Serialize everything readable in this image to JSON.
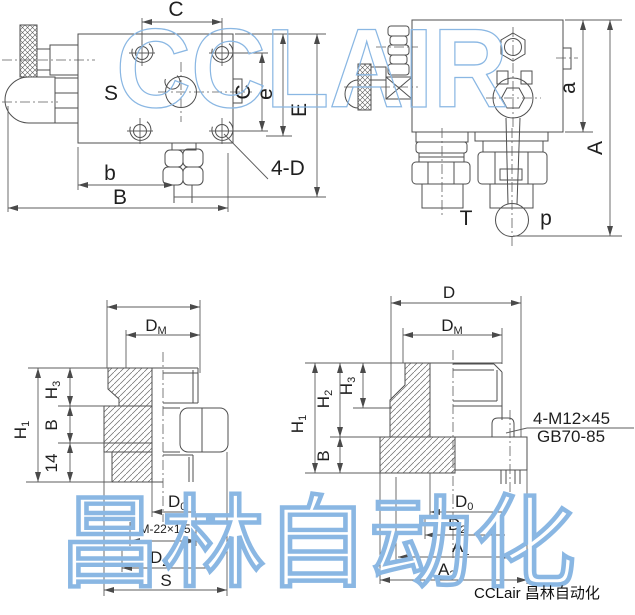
{
  "watermarks": {
    "brand_top": "CCLAIR",
    "brand_bottom": "昌林自动化"
  },
  "caption": "CCLair 昌林自动化",
  "colors": {
    "drawing_line": "#4f4f4f",
    "dimension_line": "#5c5c5c",
    "watermark_blue": "#8ab7e3",
    "label_text": "#1f1f1f"
  },
  "views": {
    "top_view": {
      "labels": {
        "c_top": "C",
        "s_body": "S",
        "c_right": "C",
        "e_small": "e",
        "e_big": "E",
        "holes": "4-D",
        "b_small": "b",
        "b_big": "B"
      }
    },
    "side_view": {
      "labels": {
        "a_small": "a",
        "a_big": "A",
        "t_port": "T",
        "p_port": "p"
      }
    },
    "section_left": {
      "labels": {
        "dm": {
          "main": "D",
          "sub": "M"
        },
        "h1": {
          "main": "H",
          "sub": "1"
        },
        "h3": {
          "main": "H",
          "sub": "3"
        },
        "b": "B",
        "n14": "14",
        "d0": {
          "main": "D",
          "sub": "0"
        },
        "thread_spec": "M-22×1.5",
        "d2": {
          "main": "D",
          "sub": "2"
        },
        "s": "S"
      }
    },
    "section_right": {
      "labels": {
        "d": "D",
        "dm": {
          "main": "D",
          "sub": "M"
        },
        "h1": {
          "main": "H",
          "sub": "1"
        },
        "h2": {
          "main": "H",
          "sub": "2"
        },
        "h3": {
          "main": "H",
          "sub": "3"
        },
        "b": "B",
        "bolt_spec": "4-M12×45",
        "bolt_standard": "GB70-85",
        "d0": {
          "main": "D",
          "sub": "0"
        },
        "d2": {
          "main": "D",
          "sub": "2"
        },
        "a1": {
          "main": "A",
          "sub": "1"
        },
        "a2": {
          "main": "A",
          "sub": "2"
        }
      }
    }
  }
}
